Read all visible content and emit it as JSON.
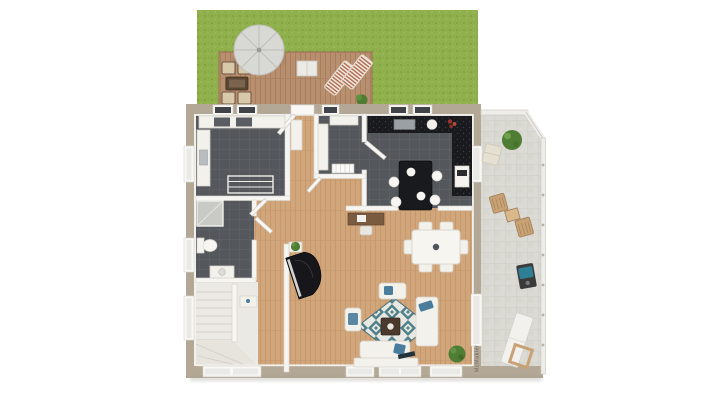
{
  "scene": {
    "type_label": "3d-floor-plan-top-view",
    "watermark_text": "McMakler"
  },
  "colors": {
    "background": "#ffffff",
    "lawn": "#8fb04c",
    "deck_wood": "#b9906f",
    "interior_wood": "#d2a67b",
    "dark_tile": "#54575b",
    "patio_tile": "#dbdad4",
    "outer_wall": "#b3a895",
    "inner_wall": "#f6f5f1",
    "counter_black": "#191a1d",
    "furniture_white": "#f3f1ec",
    "accent_blue": "#4a7c9b",
    "rug_teal": "#50808a",
    "plant_green": "#4e7d33",
    "piano_black": "#17171b",
    "umbrella_gray": "#d8d8d4",
    "grill_teal": "#2e7f96",
    "patio_wood_chair": "#c8a274",
    "lounger_stripe": "#b26a4d"
  },
  "objects": [
    "lawn",
    "wood-deck",
    "parasol",
    "garden-lounge-set",
    "sun-loungers",
    "deck-side-table",
    "garden-bush",
    "utility-room",
    "bathroom",
    "entry-hall",
    "storage-closet",
    "kitchen",
    "kitchen-island",
    "dining-table",
    "desk",
    "grand-piano",
    "staircase",
    "living-room",
    "area-rug",
    "sofa-set",
    "coffee-table",
    "tv-sideboard",
    "patio",
    "patio-dining-chairs",
    "bbq-grill",
    "patio-table",
    "potted-plants",
    "radiator",
    "windows",
    "doors"
  ]
}
